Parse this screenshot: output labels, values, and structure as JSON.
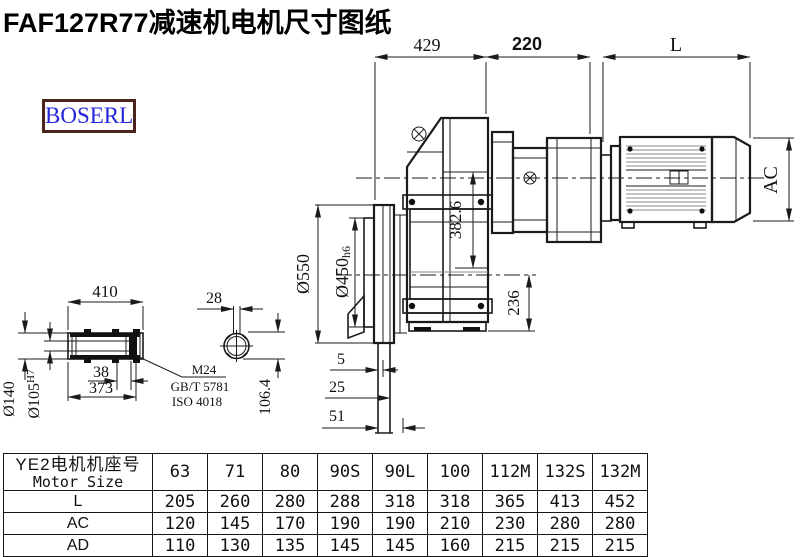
{
  "title": "FAF127R77减速机电机尺寸图纸",
  "logo": {
    "text": "BOSERL"
  },
  "colors": {
    "line": "#1b1b1b",
    "logo_text": "#2426d8",
    "logo_border": "#4a241c"
  },
  "dims": {
    "gearbox_width": "429",
    "adapter_width": "220",
    "motor_length": "L",
    "flange_od": "Ø550",
    "spigot_d": "Ø450",
    "spigot_tol": "h6",
    "center_height": "382.6",
    "base_height": "236",
    "motor_od": "AC",
    "shaft_length": "410",
    "shaft_step": "38",
    "shaft_inner_len": "373",
    "hub_od": "Ø140",
    "bore_d": "Ø105",
    "bore_tol": "H7",
    "key_width": "28",
    "key_depth": "106.4",
    "flange_off_1": "5",
    "flange_off_2": "25",
    "flange_off_3": "51",
    "note_line1": "M24",
    "note_line2": "GB/T 5781",
    "note_line3": "ISO 4018"
  },
  "table": {
    "header_cn": "YE2电机机座号",
    "header_en": "Motor Size",
    "columns": [
      "63",
      "71",
      "80",
      "90S",
      "90L",
      "100",
      "112M",
      "132S",
      "132M"
    ],
    "rows": [
      {
        "label": "L",
        "values": [
          "205",
          "260",
          "280",
          "288",
          "318",
          "318",
          "365",
          "413",
          "452"
        ]
      },
      {
        "label": "AC",
        "values": [
          "120",
          "145",
          "170",
          "190",
          "190",
          "210",
          "230",
          "280",
          "280"
        ]
      },
      {
        "label": "AD",
        "values": [
          "110",
          "130",
          "135",
          "145",
          "145",
          "160",
          "215",
          "215",
          "215"
        ]
      }
    ]
  }
}
